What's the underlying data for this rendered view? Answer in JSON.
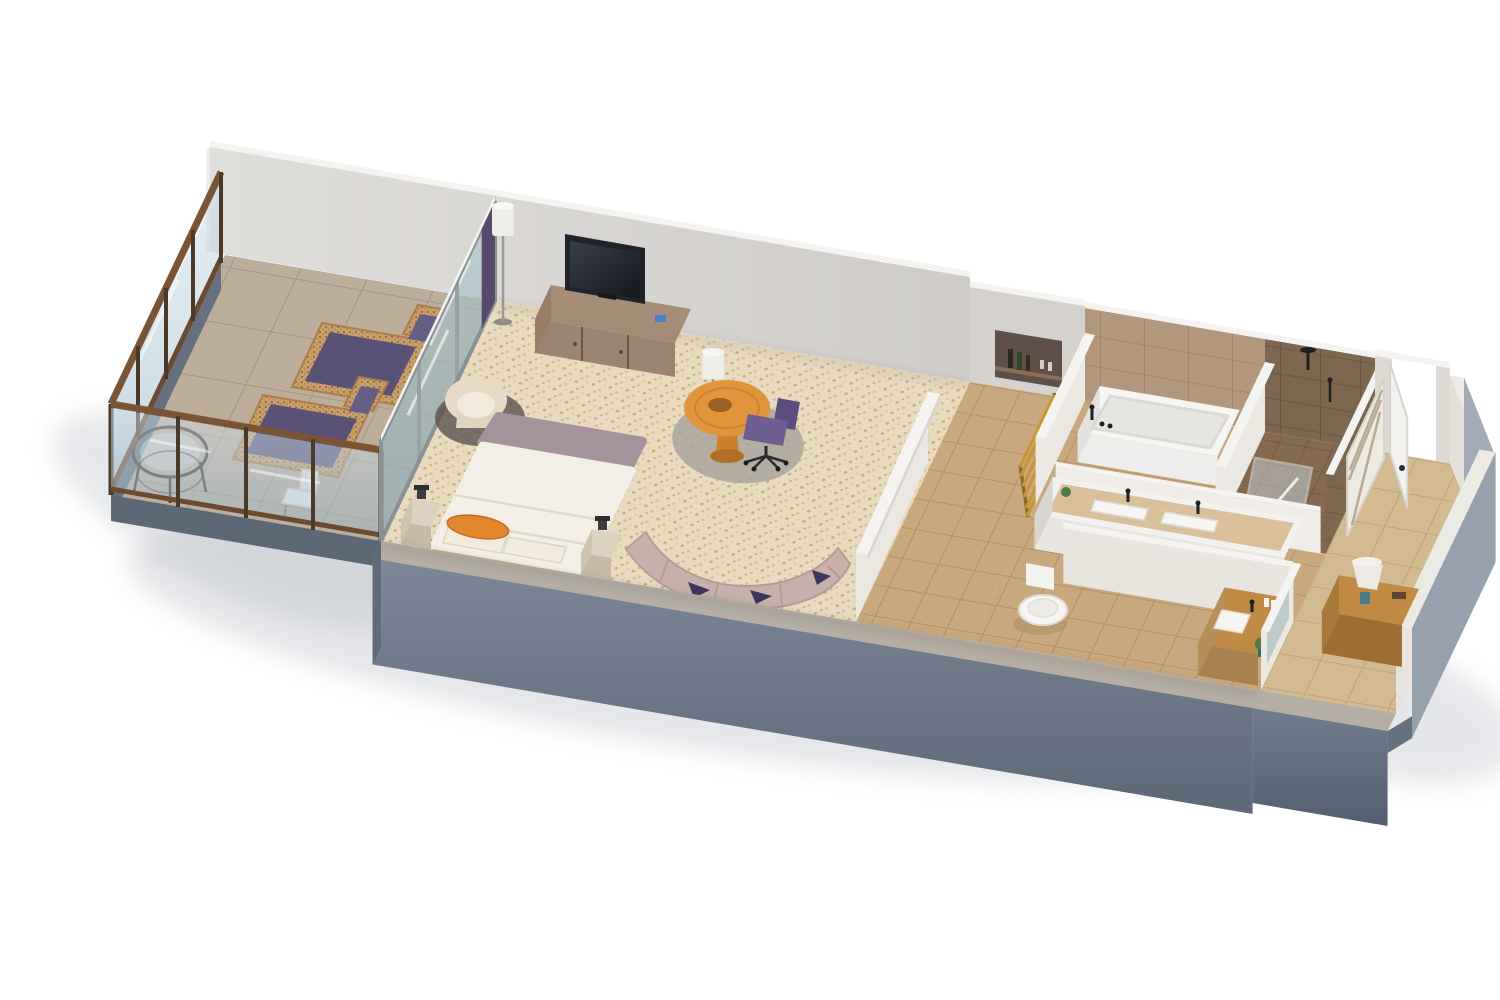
{
  "scene": {
    "type": "3d-floor-plan-render",
    "view": "axonometric-dollhouse-cutaway",
    "subject": "hotel-suite-with-balcony",
    "background": "#ffffff"
  },
  "colors": {
    "background": "#ffffff",
    "wall_white_face": "#dbd8d4",
    "wall_white_top": "#f4f3f0",
    "wall_inner_lit": "#ebe7e1",
    "outer_wall_slate": "#6f7a8c",
    "outer_wall_slate_dark": "#5d6877",
    "outer_wall_slate_light": "#97a0ad",
    "outer_wall_top": "#b5aea4",
    "carpet_base": "#e9dbc0",
    "carpet_speckle": "#c9ad85",
    "tile_bath": "#c8a87e",
    "tile_grout": "#ad8c60",
    "tile_balcony": "#bcae9b",
    "tile_balcony_grout": "#a3947f",
    "tile_shower_dark": "#83694f",
    "wall_tile": "#b1977b",
    "wall_tile_grout": "#9a8163",
    "wall_tile_dark": "#7d6750",
    "wood_media_console": "#9b8472",
    "wood_entry_console": "#c08a45",
    "desk_orange": "#e0953c",
    "chair_purple": "#6f5f91",
    "cushion_purple": "#5a5276",
    "pillow_orange": "#e2862e",
    "bed_white": "#f4efe6",
    "bed_fold_mauve": "#a5939c",
    "bed_runner_gold": "#d9b96a",
    "sofa_taupe": "#c7b1aa",
    "wicker": "#c89f6b",
    "glass_blue": "#a9c6d6",
    "glass_teal": "#7fa8ab",
    "frame_bronze": "#6b4a2f",
    "tub_white": "#f6f5f2",
    "plant_green": "#4d7c4a",
    "tv_black": "#202329",
    "shadow": "#aeb3bc"
  },
  "rooms": [
    {
      "id": "balcony",
      "floor": "stone-tile",
      "furniture": [
        "glass-railing",
        "sun-lounger",
        "sun-lounger",
        "wire-bistro-table",
        "outdoor-chair"
      ]
    },
    {
      "id": "bedroom",
      "floor": "mosaic-carpet",
      "furniture": [
        "sliding-glass-door",
        "curtain",
        "floor-lamp",
        "media-console",
        "tv",
        "armchair",
        "king-bed",
        "orange-accent-pillow",
        "nightstand",
        "nightstand",
        "table-lamp",
        "table-lamp",
        "round-desk-table",
        "desk-chair",
        "area-rug",
        "curved-sofa",
        "floor-lamp"
      ]
    },
    {
      "id": "hallway",
      "floor": "tile",
      "furniture": [
        "minibar-shelf",
        "ladder-towel-rack"
      ]
    },
    {
      "id": "bathroom",
      "floor": "tile",
      "furniture": [
        "freestanding-bathtub",
        "deck-faucet",
        "double-vanity",
        "vanity-faucet",
        "vanity-faucet",
        "sink",
        "sink"
      ]
    },
    {
      "id": "shower-room",
      "floor": "dark-tile",
      "furniture": [
        "glass-shower-door",
        "shower-set"
      ]
    },
    {
      "id": "water-closet",
      "floor": "tile",
      "furniture": [
        "toilet",
        "wood-vanity",
        "vanity-sink",
        "faucet",
        "mirror",
        "plant",
        "amenity-bottles"
      ]
    },
    {
      "id": "entry-foyer",
      "floor": "tile",
      "furniture": [
        "entry-door",
        "door-handle",
        "closet-shelves",
        "console-table",
        "table-lamp"
      ]
    }
  ]
}
